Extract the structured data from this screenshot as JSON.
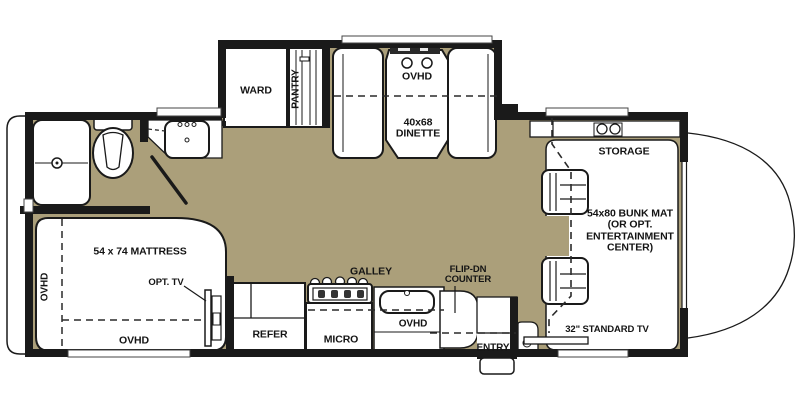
{
  "floorplan": {
    "labels": {
      "ward": "WARD",
      "pantry": "PANTRY",
      "dinette_ovhd": "OVHD",
      "dinette": "40x68\nDINETTE",
      "storage": "STORAGE",
      "bunk": "54x80 BUNK MAT\n(OR OPT.\nENTERTAINMENT\nCENTER)",
      "mattress": "54 x 74 MATTRESS",
      "opt_tv": "OPT. TV",
      "bed_ovhd_side": "OVHD",
      "bed_ovhd_foot": "OVHD",
      "galley": "GALLEY",
      "refer": "REFER",
      "micro": "MICRO",
      "galley_ovhd": "OVHD",
      "flip_counter": "FLIP-DN\nCOUNTER",
      "entry": "ENTRY",
      "standard_tv": "32\"  STANDARD TV"
    },
    "colors": {
      "floor": "#ab9f7a",
      "wall": "#1a1a1a"
    }
  }
}
